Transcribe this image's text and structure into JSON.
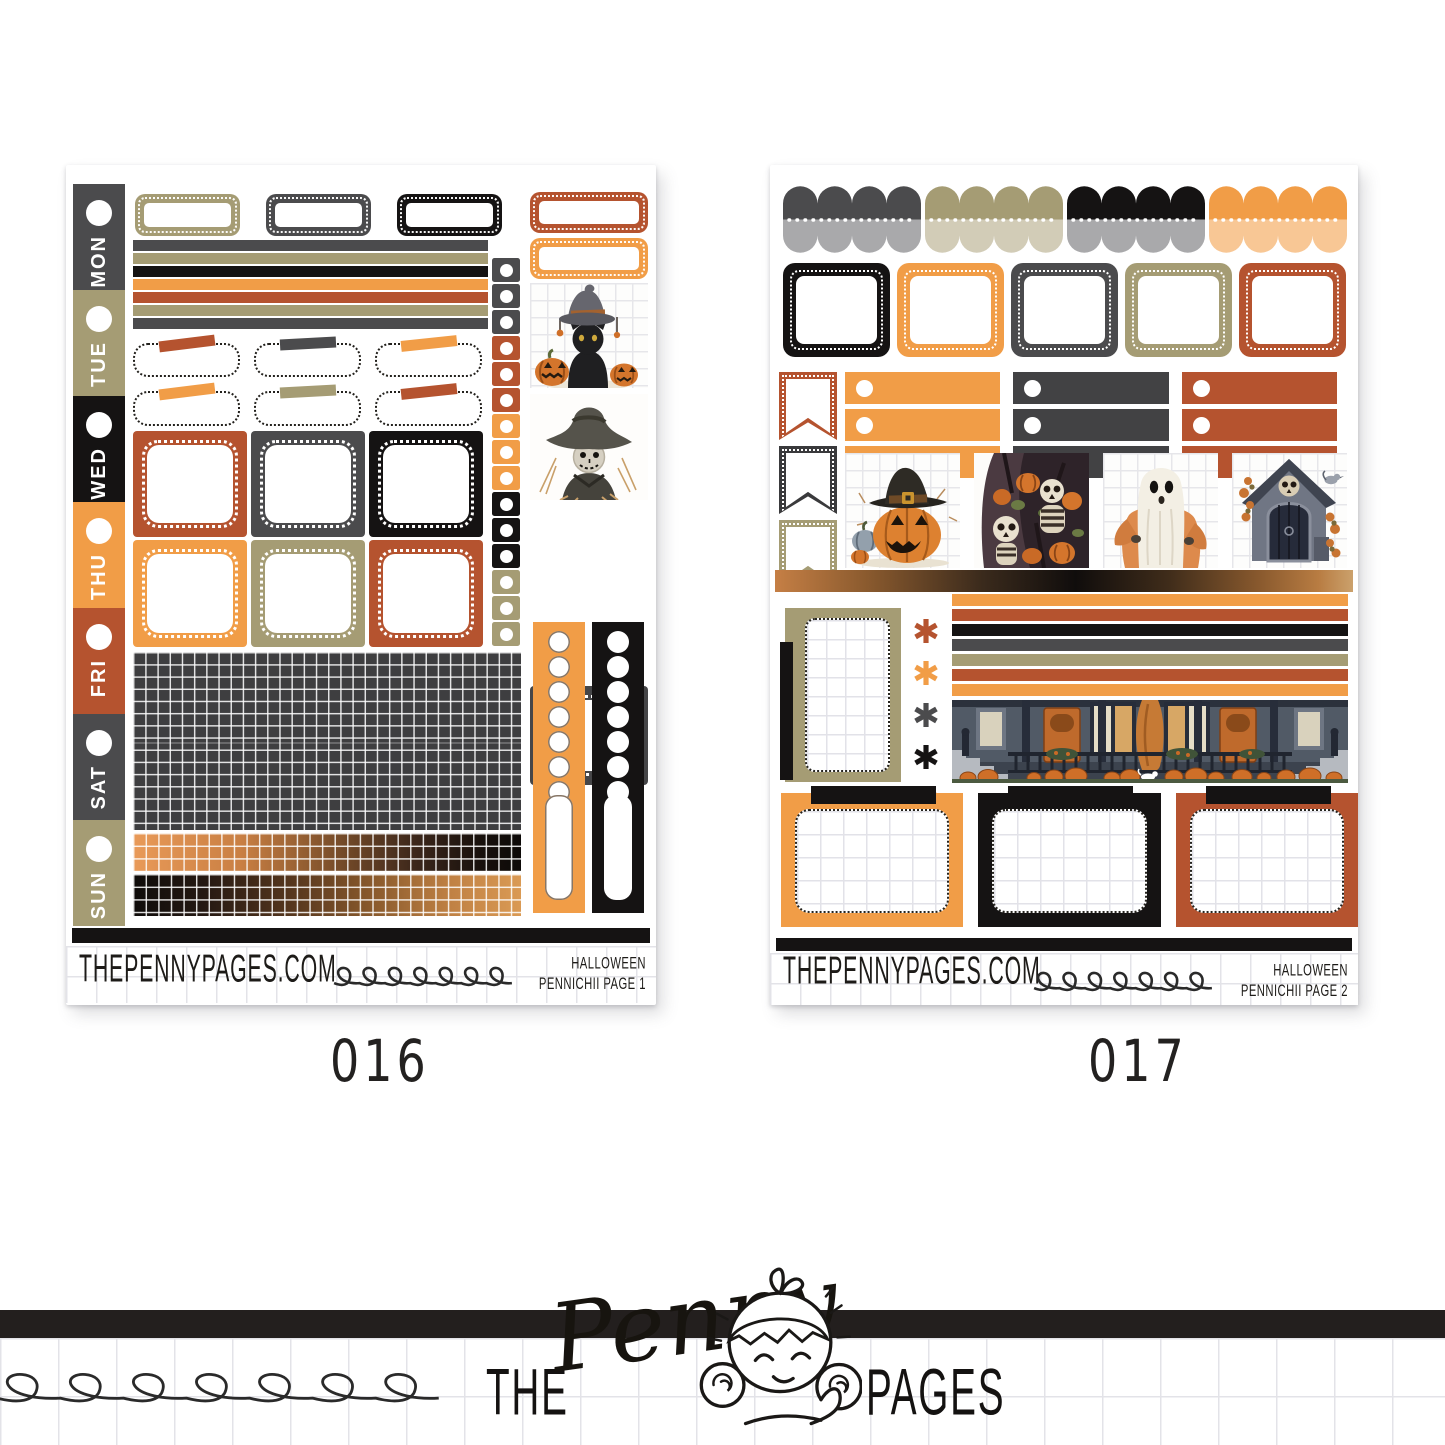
{
  "palette": {
    "dark_gray": "#4b4b4d",
    "olive": "#a59c74",
    "black": "#151313",
    "orange": "#f19d47",
    "rust": "#b5532f",
    "gray": "#a9a9ab",
    "light_olive": "#d2ccb7",
    "light_orange": "#f8c795",
    "grid_dark": "#3e3e40",
    "ink": "#1c1a18",
    "paper_line": "#e3e3e8"
  },
  "sheets": [
    {
      "code": "016",
      "footer": {
        "site": "THEPENNYPAGES.COM",
        "theme": "HALLOWEEN",
        "page": "PENNICHII PAGE 1"
      },
      "days": [
        {
          "label": "MON",
          "color": "#4b4b4d"
        },
        {
          "label": "TUE",
          "color": "#a59c74"
        },
        {
          "label": "WED",
          "color": "#151313"
        },
        {
          "label": "THU",
          "color": "#f19d47"
        },
        {
          "label": "FRI",
          "color": "#b5532f"
        },
        {
          "label": "SAT",
          "color": "#4b4b4d"
        },
        {
          "label": "SUN",
          "color": "#a59c74"
        }
      ],
      "quarter_boxes": [
        "#a59c74",
        "#4b4b4d",
        "#151313"
      ],
      "side_quarter_boxes": [
        "#b5532f",
        "#f19d47"
      ],
      "washi": [
        "#4b4b4d",
        "#a59c74",
        "#151313",
        "#f19d47",
        "#b5532f",
        "#a59c74",
        "#4b4b4d"
      ],
      "tape_row1": [
        "#b5532f",
        "#4b4b4d",
        "#f19d47"
      ],
      "tape_row2": [
        "#f19d47",
        "#a59c74",
        "#b5532f"
      ],
      "full_boxes_row1": [
        "#b5532f",
        "#4b4b4d",
        "#151313"
      ],
      "full_boxes_row2": [
        "#f19d47",
        "#a59c74",
        "#b5532f"
      ],
      "checkboxes": [
        "#4b4b4d",
        "#4b4b4d",
        "#4b4b4d",
        "#b5532f",
        "#b5532f",
        "#b5532f",
        "#f19d47",
        "#f19d47",
        "#f19d47",
        "#151313",
        "#151313",
        "#151313",
        "#a59c74",
        "#a59c74",
        "#a59c74"
      ],
      "checklist_columns": [
        "#f19d47",
        "#151313"
      ],
      "side_box_color": "#464648",
      "images": [
        "black-cat-witch-hat-pumpkins",
        "scarecrow"
      ]
    },
    {
      "code": "017",
      "footer": {
        "site": "THEPENNYPAGES.COM",
        "theme": "HALLOWEEN",
        "page": "PENNICHII PAGE 2"
      },
      "scallops": [
        {
          "top": "#4b4b4d",
          "bottom": "#a9a9ab"
        },
        {
          "top": "#a59c74",
          "bottom": "#d2ccb7"
        },
        {
          "top": "#151313",
          "bottom": "#a9a9ab"
        },
        {
          "top": "#f19d47",
          "bottom": "#f8c795"
        }
      ],
      "half_boxes": [
        "#151313",
        "#f19d47",
        "#4b4b4d",
        "#a59c74",
        "#b5532f"
      ],
      "flags": [
        "#b5532f",
        "#3a3a3c",
        "#a59c74"
      ],
      "checklist_groups": [
        "#f19d47",
        "#424244",
        "#b5532f"
      ],
      "asterisks": [
        "#b5532f",
        "#f19d47",
        "#4b4b4d",
        "#151313",
        "#b5532f"
      ],
      "asterisk_char": "✱",
      "washi": [
        "#f19d47",
        "#b5532f",
        "#151313",
        "#4b4b4d",
        "#a59c74",
        "#b5532f",
        "#f19d47"
      ],
      "tab_boxes": [
        "#f19d47",
        "#151313",
        "#b5532f"
      ],
      "images": [
        "pumpkin-witch-hat",
        "skeletons-pumpkins",
        "ghost",
        "crypt-skull",
        "halloween-porch"
      ]
    }
  ],
  "branding": {
    "word_the": "THE",
    "word_penny": "Penny",
    "word_pages": "PAGES"
  }
}
